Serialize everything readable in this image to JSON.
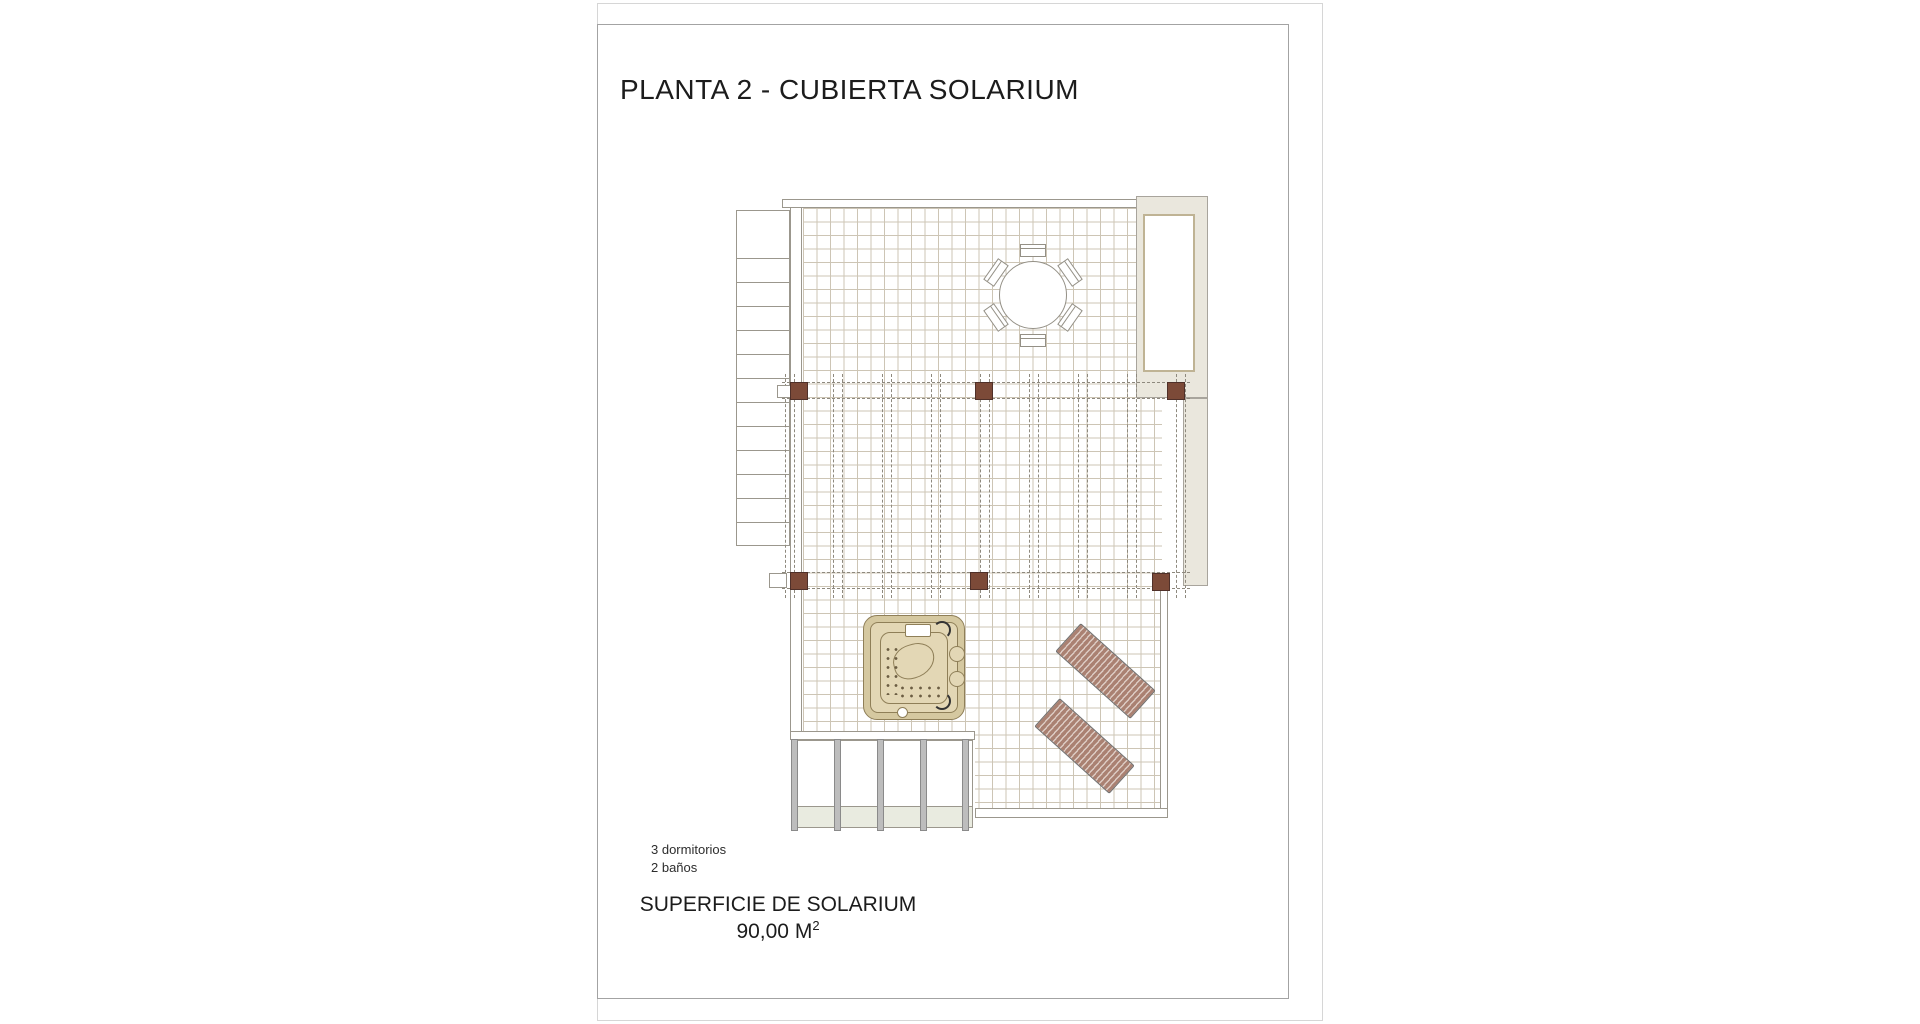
{
  "document": {
    "title": "PLANTA 2 - CUBIERTA SOLARIUM",
    "features": {
      "bedrooms": "3 dormitorios",
      "bathrooms": "2 baños"
    },
    "surface": {
      "label": "SUPERFICIE DE SOLARIUM",
      "value": "90,00 M",
      "exponent": "2"
    }
  },
  "plan": {
    "elements": [
      "staircase",
      "roof-terrace-tiled-deck",
      "skylight-shaft",
      "pergola-posts-and-rafters",
      "round-table-with-six-chairs",
      "jacuzzi",
      "two-sun-loungers",
      "lower-porch-beams"
    ],
    "colors": {
      "pergola_post": "#7c4a38",
      "lounger_stripe": "#aa8172",
      "jacuzzi_shell": "#d5c8a0",
      "wall_fill": "#eae7dd",
      "tile_grid_line": "#cdc5b5",
      "dashed_line": "#8e897e"
    }
  }
}
